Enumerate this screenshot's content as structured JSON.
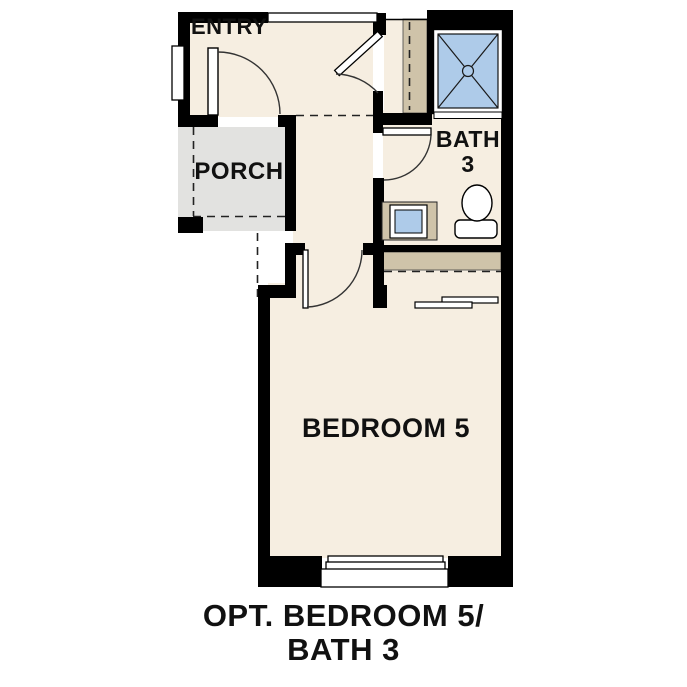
{
  "plan": {
    "title": "OPT. BEDROOM 5/ BATH 3 floor plan",
    "rooms": {
      "entry": {
        "label": "ENTRY"
      },
      "porch": {
        "label": "PORCH"
      },
      "bath": {
        "label_line1": "BATH",
        "label_line2": "3"
      },
      "bedroom": {
        "label": "BEDROOM 5"
      }
    },
    "caption": {
      "line1": "OPT. BEDROOM 5/",
      "line2": "BATH 3"
    },
    "fixtures": [
      "shower",
      "toilet",
      "vanity-sink",
      "coat-closet-rod",
      "bedroom-closet-rod",
      "sliding-closet-doors",
      "entry-door",
      "hall-door",
      "bath-door",
      "bedroom-door",
      "windows"
    ],
    "colors": {
      "bg": "#ffffff",
      "floor": "#f6eee1",
      "porch": "#e2e2e0",
      "shelf": "#cfc3a9",
      "water": "#aecbe9",
      "wall": "#000000",
      "ink": "#111111",
      "line": "#333333"
    }
  }
}
